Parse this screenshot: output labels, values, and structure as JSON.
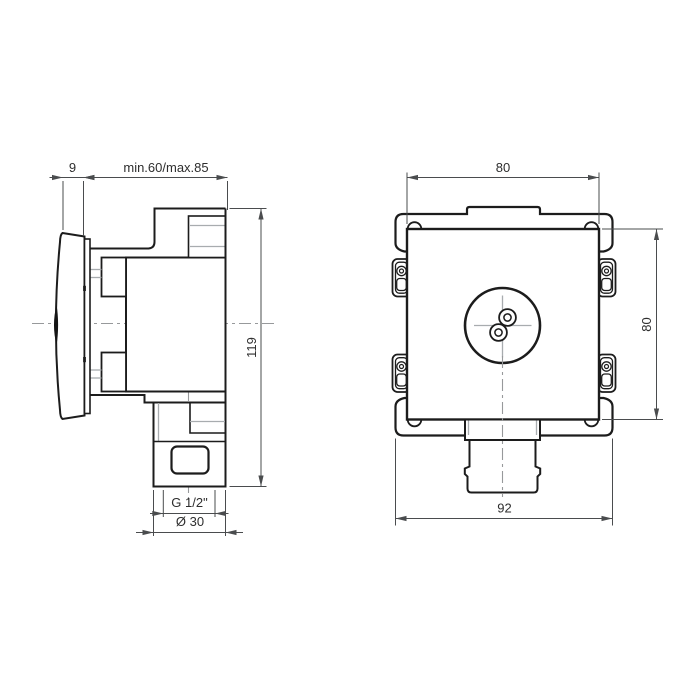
{
  "drawing": {
    "type": "technical-orthographic-2-view",
    "subject": "concealed-valve",
    "views": {
      "side_view": {
        "name": "side view",
        "dimensions": {
          "handle_depth": "9",
          "installation_depth": "min.60/max.85",
          "total_height": "119",
          "thread_size": "G 1/2\"",
          "outlet_diameter": "Ø 30"
        }
      },
      "front_view": {
        "name": "front view",
        "dimensions": {
          "body_width": "80",
          "body_height": "80",
          "plate_width": "92"
        }
      }
    },
    "colors": {
      "outline": "#1c1c1c",
      "detail_line": "#a8acaf",
      "dimension_line": "#4a4c4e",
      "centerline": "#97999b",
      "text": "#2e2e2e",
      "background": "#ffffff"
    }
  }
}
